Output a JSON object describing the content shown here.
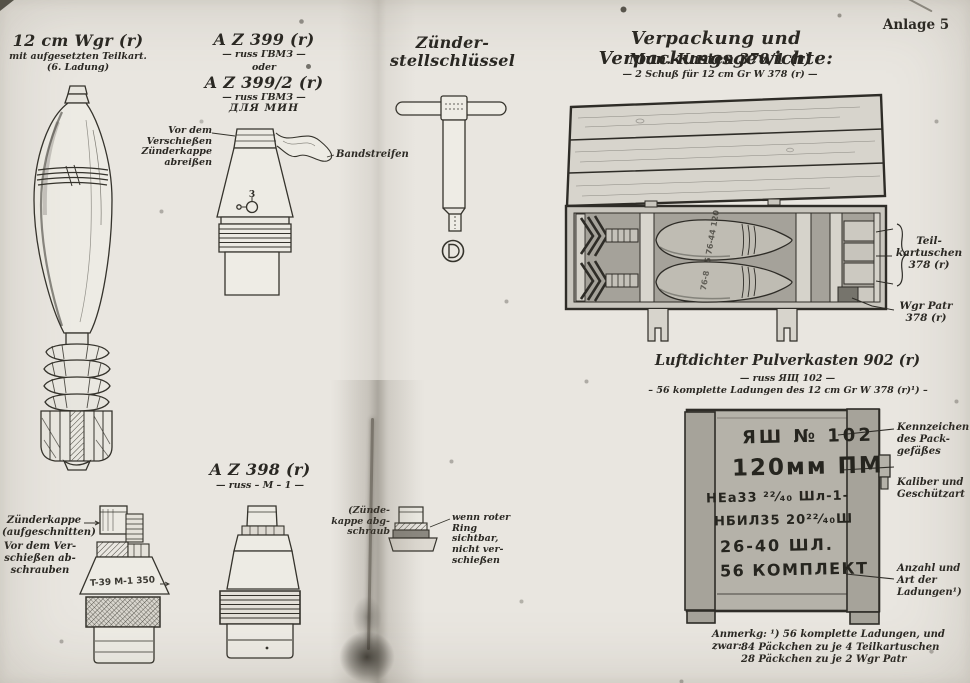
{
  "page": {
    "annotation": "Anlage 5"
  },
  "wgr": {
    "title": "12 cm Wgr (r)",
    "sub1": "mit aufgesetzten Teilkart.",
    "sub2": "(6. Ladung)"
  },
  "az399": {
    "title1": "A Z 399 (r)",
    "russ1": "— russ ГВМЗ —",
    "oder": "oder",
    "title2": "A Z 399/2 (r)",
    "russ2": "— russ ГВМЗ —",
    "russ3": "ДЛЯ МИН",
    "cap_note": "Vor dem\nVerschießen\nZünderkappe\nabreißen",
    "band_label": "Bandstreifen",
    "dial": "3"
  },
  "key": {
    "title": "Zünder-\nstellschlüssel"
  },
  "az398": {
    "title": "A Z 398 (r)",
    "russ": "— russ – M – 1 —"
  },
  "cap_cut": {
    "label_top": "Zünderkappe\n(aufgeschnitten)",
    "label_bottom": "Vor dem Ver-\nschießen ab-\nschrauben",
    "marking": "T-39  M-1  350"
  },
  "cap_off": {
    "left_note": "(Zünde-\nkappe abg-\nschraub",
    "right_note": "wenn roter\nRing sichtbar,\nnicht ver-\nschießen"
  },
  "packing": {
    "heading": "Verpackung und Verpackungsgewichte:",
    "kasten_title": "Mun.-Kasten 378/1 (r)",
    "kasten_sub": "— 2 Schuß für 12 cm Gr W 378 (r) —",
    "teilkartuschen_label": "Teil-\nkartuschen\n378 (r)",
    "wgrpatr_label": "Wgr Patr\n378 (r)",
    "shell_mark_top": "5 76-44 120",
    "shell_mark_bottom": "76-8"
  },
  "pulverkasten": {
    "title": "Luftdichter Pulverkasten 902 (r)",
    "russ": "— russ ЯЩ 102 —",
    "sub": "– 56 komplette Ladungen des 12 cm Gr W 378 (r)¹) –",
    "stencil": [
      "ЯШ № 102",
      "120мм ПМ",
      "НЕа33 ²²⁄₄₀ Шл-1-",
      "НБИЛ35 20²²⁄₄₀Ш",
      "26-40 ШЛ.",
      "56 КОМПЛЕКТ"
    ],
    "label_kennzeichen": "Kennzeichen\ndes Pack-\ngefäßes",
    "label_kaliber": "Kaliber und\nGeschützart",
    "label_anzahl": "Anzahl und\nArt der\nLadungen¹)"
  },
  "footnote": {
    "line1": "Anmerkg: ¹) 56 komplette Ladungen, und zwar:",
    "line2": "84 Päckchen zu je 4 Teilkartuschen",
    "line3": "28 Päckchen zu je 2 Wgr Patr"
  },
  "colors": {
    "paper": "#e9e6e0",
    "ink": "#2a2823"
  }
}
